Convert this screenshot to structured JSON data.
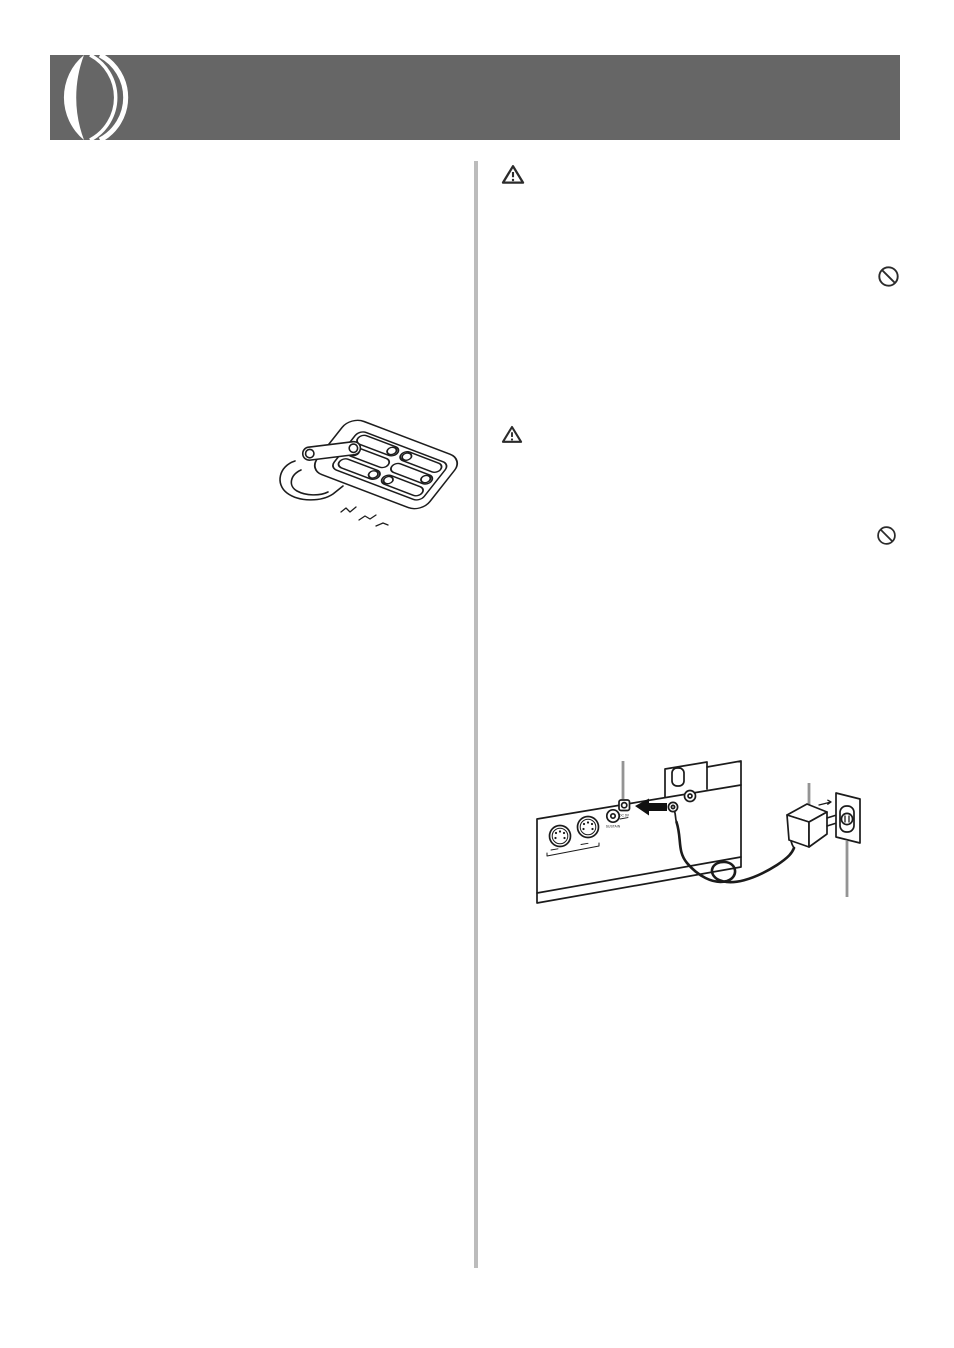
{
  "header": {
    "bar_color": "#666666",
    "logo": "lens-mark"
  },
  "divider": {
    "color": "#bcbcbc"
  },
  "right_column": {
    "safety_icons": [
      {
        "type": "warning-triangle"
      },
      {
        "type": "prohibition-circle"
      },
      {
        "type": "warning-triangle"
      },
      {
        "type": "prohibition-circle"
      }
    ]
  },
  "figures": {
    "battery_compartment": {
      "description": "batteries installed in battery compartment"
    },
    "power_connection": {
      "description": "AC adaptor connecting DC 9V jack to wall outlet",
      "jack_labels": {
        "sustain": "SUSTAIN",
        "dc": "DC 9V"
      }
    }
  }
}
